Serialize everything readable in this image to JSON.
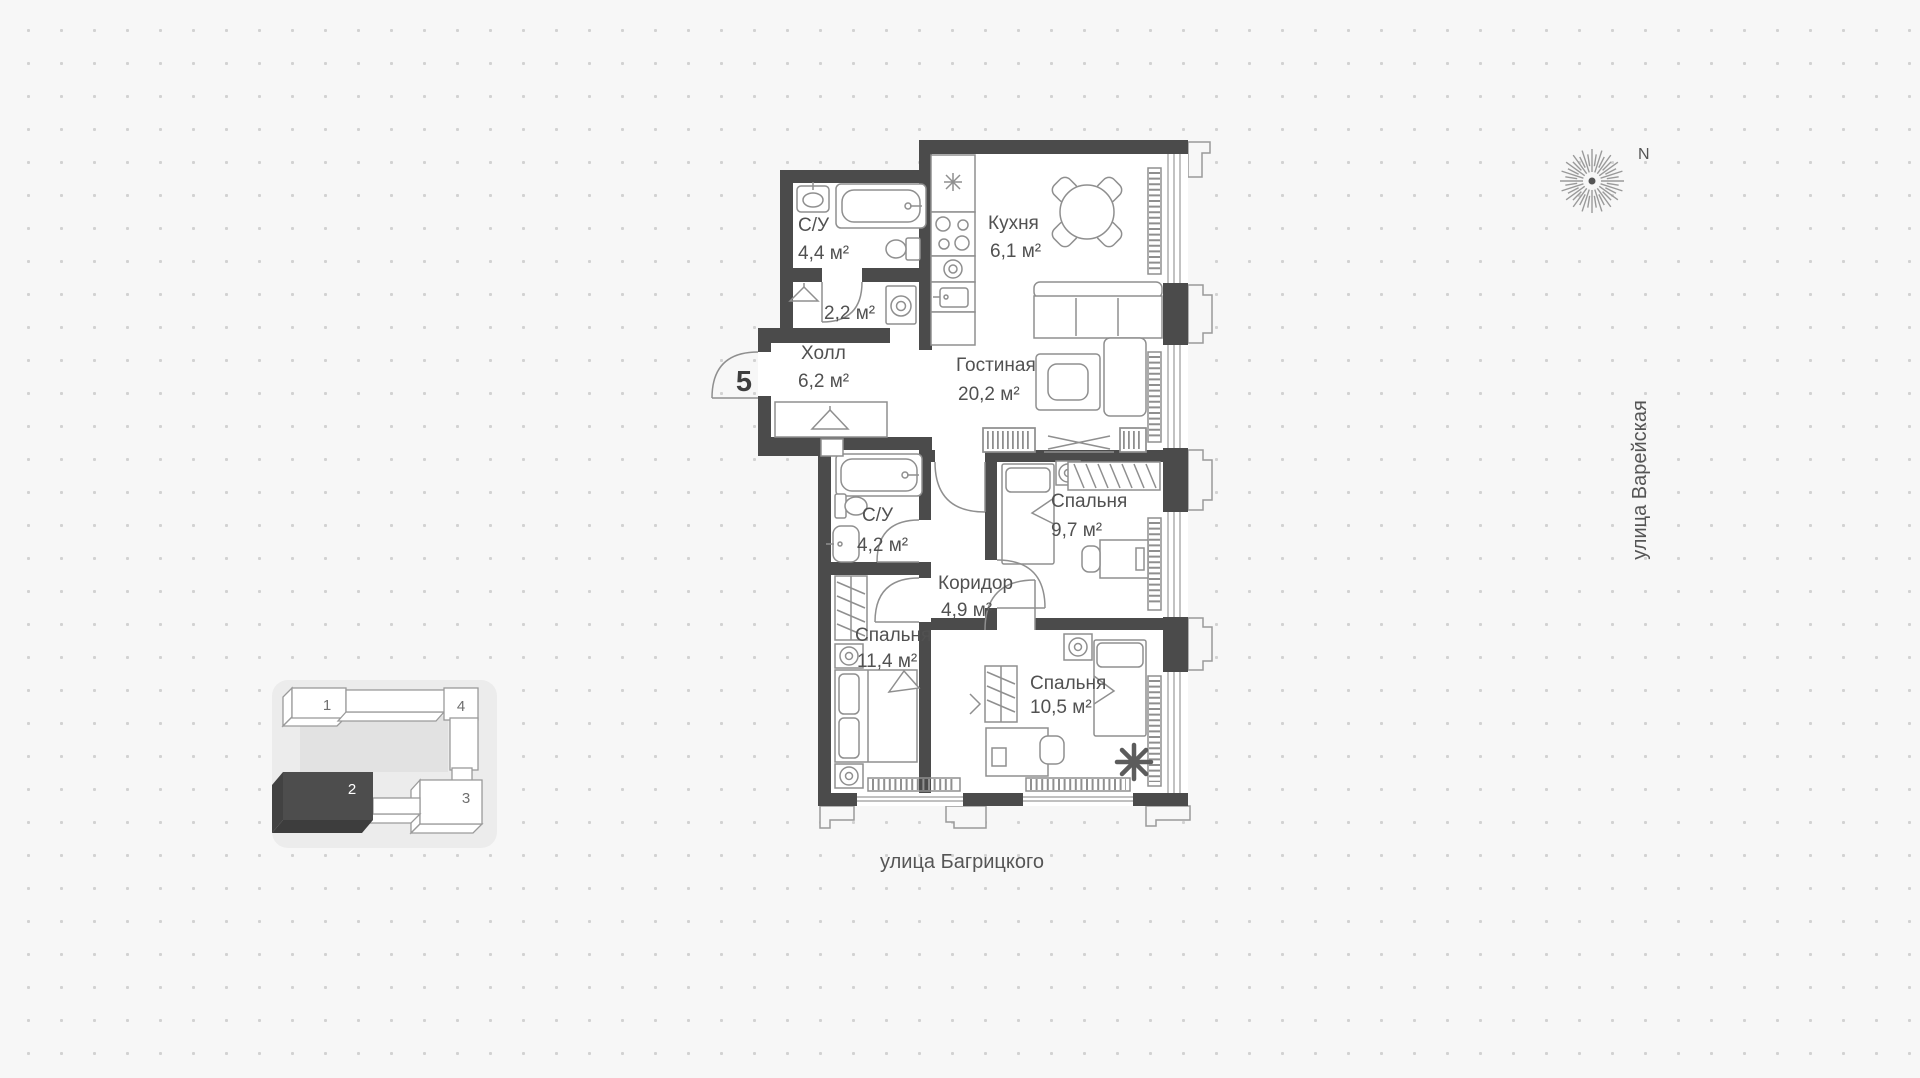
{
  "plan": {
    "apartment_number": "5",
    "rooms": {
      "bathroom_top": {
        "name": "С/У",
        "area": "4,4 м²"
      },
      "wardrobe_nook": {
        "area": "2,2 м²"
      },
      "kitchen": {
        "name": "Кухня",
        "area": "6,1 м²"
      },
      "hall": {
        "name": "Холл",
        "area": "6,2 м²"
      },
      "living_room": {
        "name": "Гостиная",
        "area": "20,2 м²"
      },
      "bathroom_mid": {
        "name": "С/У",
        "area": "4,2 м²"
      },
      "bedroom_right": {
        "name": "Спальня",
        "area": "9,7 м²"
      },
      "corridor": {
        "name": "Коридор",
        "area": "4,9 м²"
      },
      "bedroom_left": {
        "name": "Спальня",
        "area": "11,4 м²"
      },
      "bedroom_bottom": {
        "name": "Спальня",
        "area": "10,5 м²"
      }
    }
  },
  "streets": {
    "right": "улица Варейская",
    "bottom": "улица Багрицкого"
  },
  "compass": {
    "north_label": "N"
  },
  "minimap": {
    "building_blocks": [
      {
        "label": "1",
        "highlighted": false
      },
      {
        "label": "2",
        "highlighted": true
      },
      {
        "label": "3",
        "highlighted": false
      },
      {
        "label": "4",
        "highlighted": false
      }
    ]
  },
  "colors": {
    "walls": "#4b4b4b",
    "furniture_lines": "#8f8f8f",
    "labels": "#515151",
    "background": "#f7f7f7",
    "dot_grid": "#d2d2d2",
    "minimap_highlight": "#4d4d4d",
    "minimap_panel": "#ececec"
  }
}
